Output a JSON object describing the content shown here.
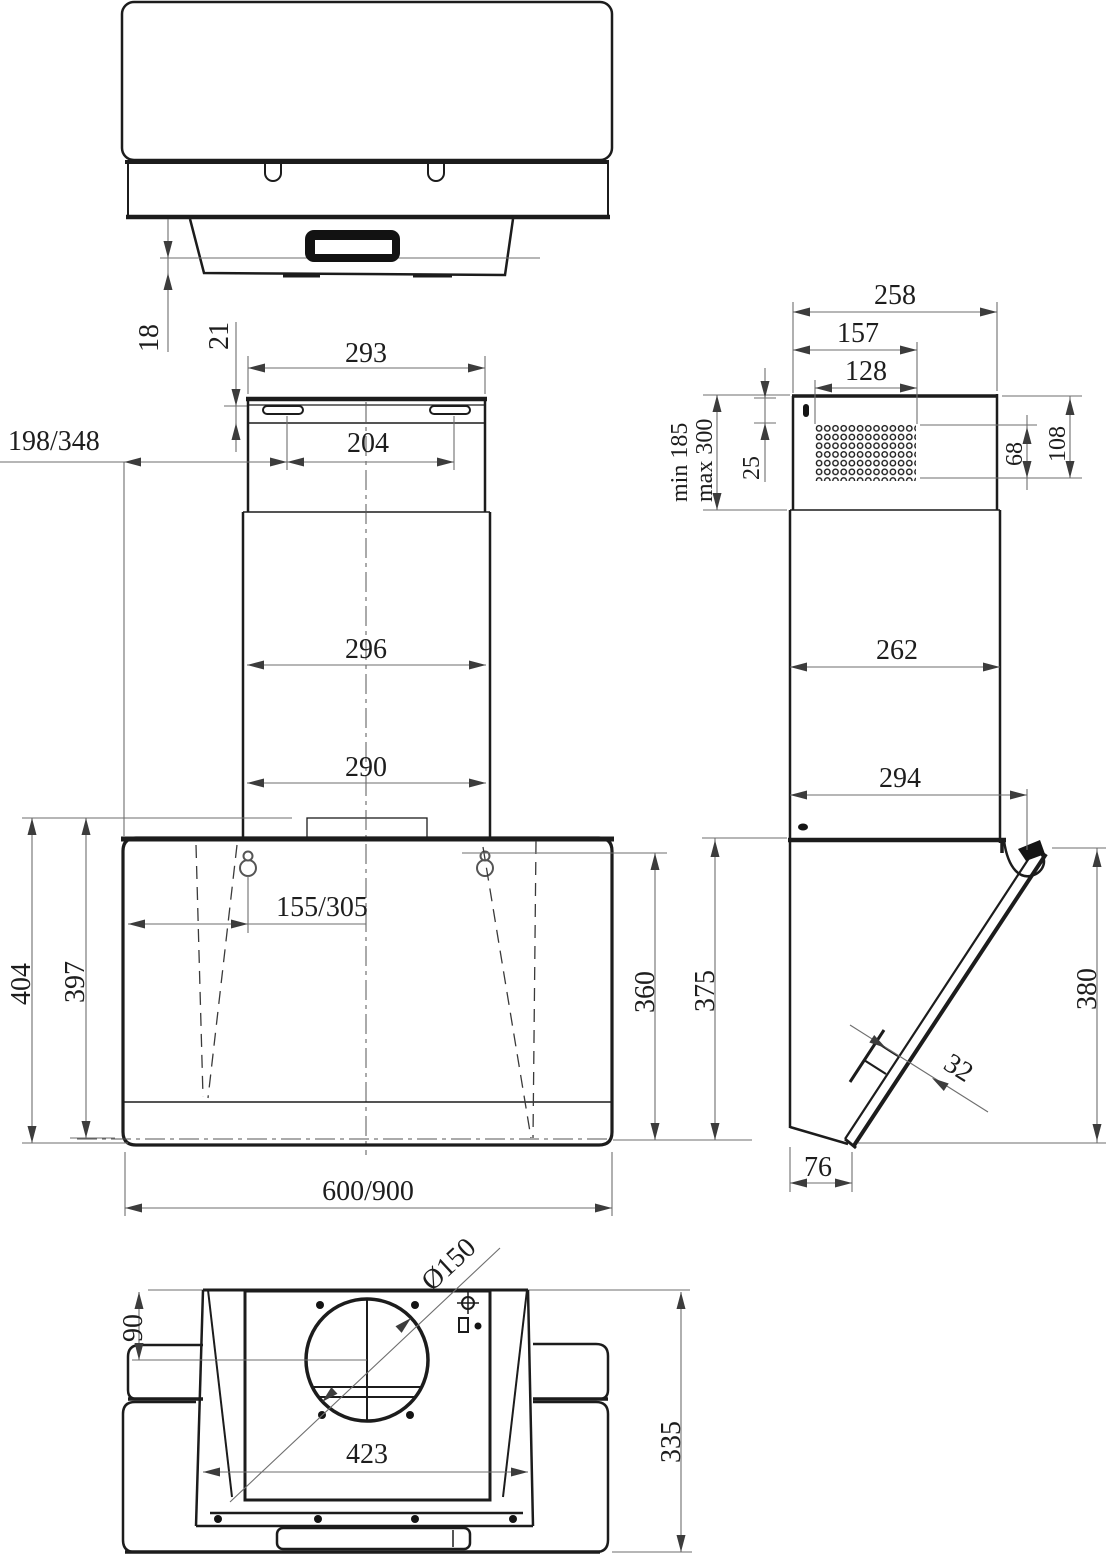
{
  "drawing": {
    "type": "technical-dimension-drawing",
    "subject": "Wall-mounted inclined kitchen extractor hood — four orthographic views with millimetre dimensions",
    "background": "#ffffff",
    "object_line_color": "#1c1c1c",
    "dimension_line_color": "#6e6e6e",
    "views": {
      "top": {
        "label": "top view",
        "dims": {
          "d18": "18",
          "d21": "21"
        }
      },
      "front": {
        "label": "front view",
        "dims": {
          "w293": "293",
          "w204": "204",
          "w198_348": "198/348",
          "w296": "296",
          "w290": "290",
          "w155_305": "155/305",
          "h404": "404",
          "h397": "397",
          "h360": "360",
          "w600_900": "600/900"
        }
      },
      "side": {
        "label": "side view",
        "dims": {
          "d258": "258",
          "d157": "157",
          "d128": "128",
          "dmin": "min 185",
          "dmax": "max 300",
          "d25": "25",
          "d68": "68",
          "d108": "108",
          "d262": "262",
          "d294": "294",
          "d375": "375",
          "d380": "380",
          "d32": "32",
          "d76": "76"
        }
      },
      "bottom": {
        "label": "bottom view",
        "dims": {
          "dia": "Ø150",
          "d90": "90",
          "d423": "423",
          "d335": "335"
        }
      }
    }
  }
}
